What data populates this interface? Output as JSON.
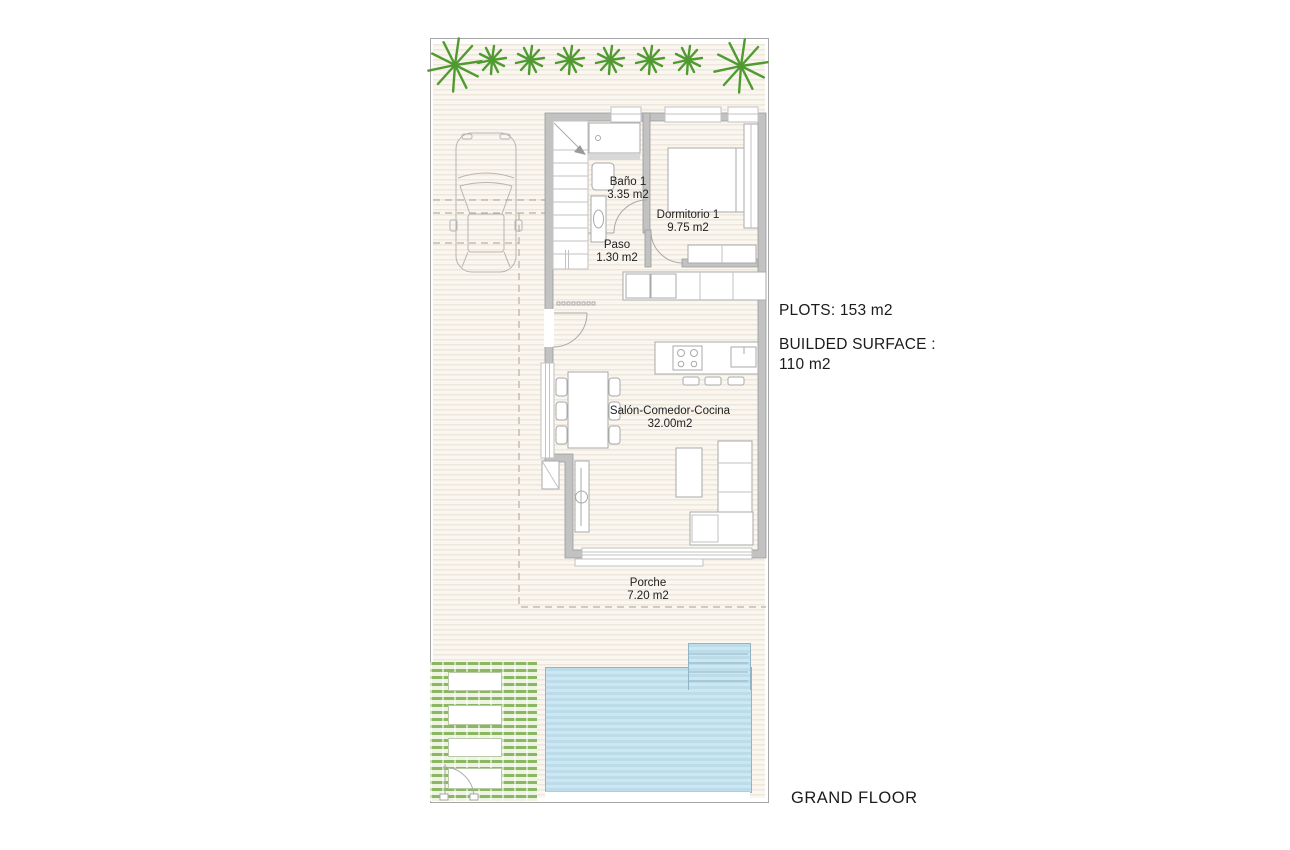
{
  "title": "GRAND FLOOR",
  "annotations": {
    "plots": "PLOTS: 153 m2",
    "builded_surface_label": "BUILDED SURFACE :",
    "builded_surface_value": "110 m2"
  },
  "rooms": [
    {
      "name": "Baño 1",
      "area": "3.35 m2"
    },
    {
      "name": "Dormitorio 1",
      "area": "9.75 m2"
    },
    {
      "name": "Paso",
      "area": "1.30 m2"
    },
    {
      "name": "Salón-Comedor-Cocina",
      "area": "32.00m2"
    },
    {
      "name": "Porche",
      "area": "7.20 m2"
    }
  ],
  "icons": {
    "palm-tree": "green starburst frond glyph",
    "car": "top-view car outline",
    "gate": "quarter-arc door swing",
    "stairs": "treads with direction arrow"
  },
  "colors": {
    "palm": "#4f9b31",
    "garden-stripe": "#8bb763",
    "garden-bg": "#eef4e4",
    "pool-fill": "#cde7f2",
    "pool-stripe": "#bcdcea",
    "pool-edge": "#8fb5c6",
    "wall-fill": "#c2c2c2",
    "wall-edge": "#9a9a9a",
    "ground-a": "#efe6dc",
    "ground-b": "#faf6f0",
    "line": "#a9a9a9",
    "dash": "#bbaf9f",
    "text": "#1c1c1c"
  }
}
